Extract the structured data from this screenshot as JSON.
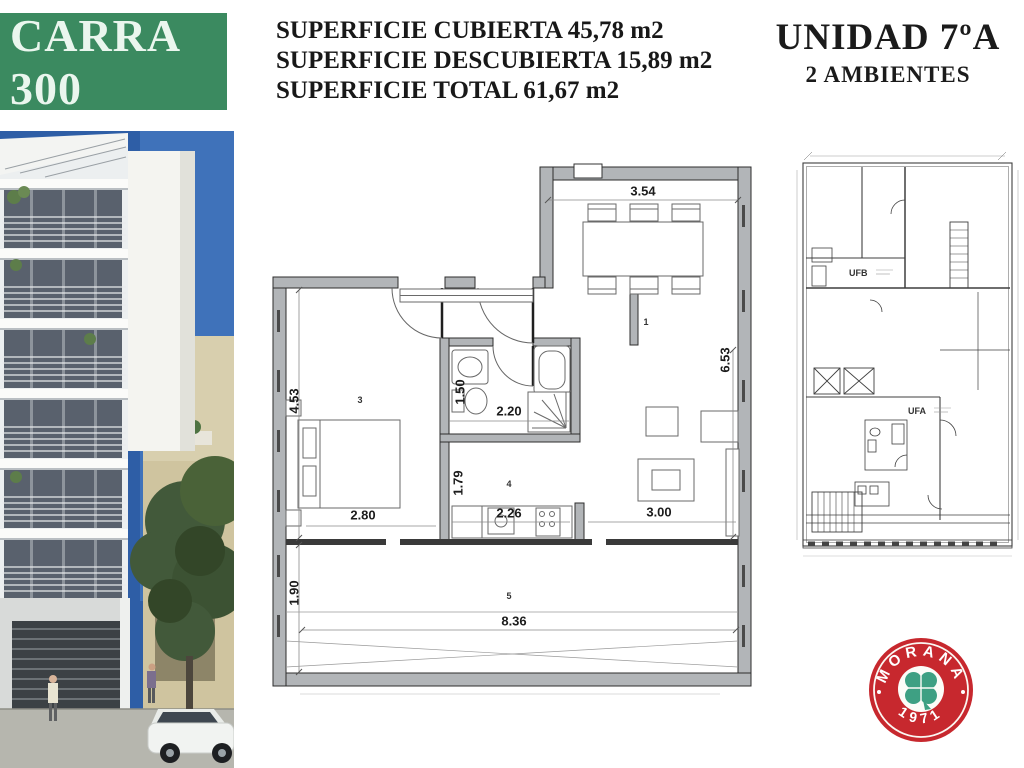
{
  "banner": {
    "title": "CARRA 300"
  },
  "surfaces": {
    "line1": "SUPERFICIE CUBIERTA 45,78 m2",
    "line2": "SUPERFICIE DESCUBIERTA 15,89 m2",
    "line3": "SUPERFICIE TOTAL 61,67 m2"
  },
  "unit": {
    "title": "UNIDAD 7ºA",
    "subtitle": "2 AMBIENTES"
  },
  "floor_plan": {
    "dims": {
      "top": "3.54",
      "right": "6.53",
      "left_upper": "4.53",
      "left_lower": "1.90",
      "bedroom": "2.80",
      "bath_width": "2.20",
      "bath_height": "1.50",
      "hall_height": "1.79",
      "kitchen": "2.26",
      "living": "3.00",
      "balcony": "8.36"
    },
    "rooms": {
      "living": "1",
      "bedroom": "3",
      "kitchen": "4",
      "balcony": "5"
    }
  },
  "key_plan": {
    "unit_b_label": "UFB",
    "unit_a_label": "UFA"
  },
  "logo": {
    "brand": "MORANA",
    "year": "1971"
  },
  "colors": {
    "banner_green": "#3b8a60",
    "logo_red": "#c7282e",
    "clover_green": "#3ea083",
    "wall_gray": "#b2b5b8",
    "sky_blue": "#2e5ea6"
  }
}
